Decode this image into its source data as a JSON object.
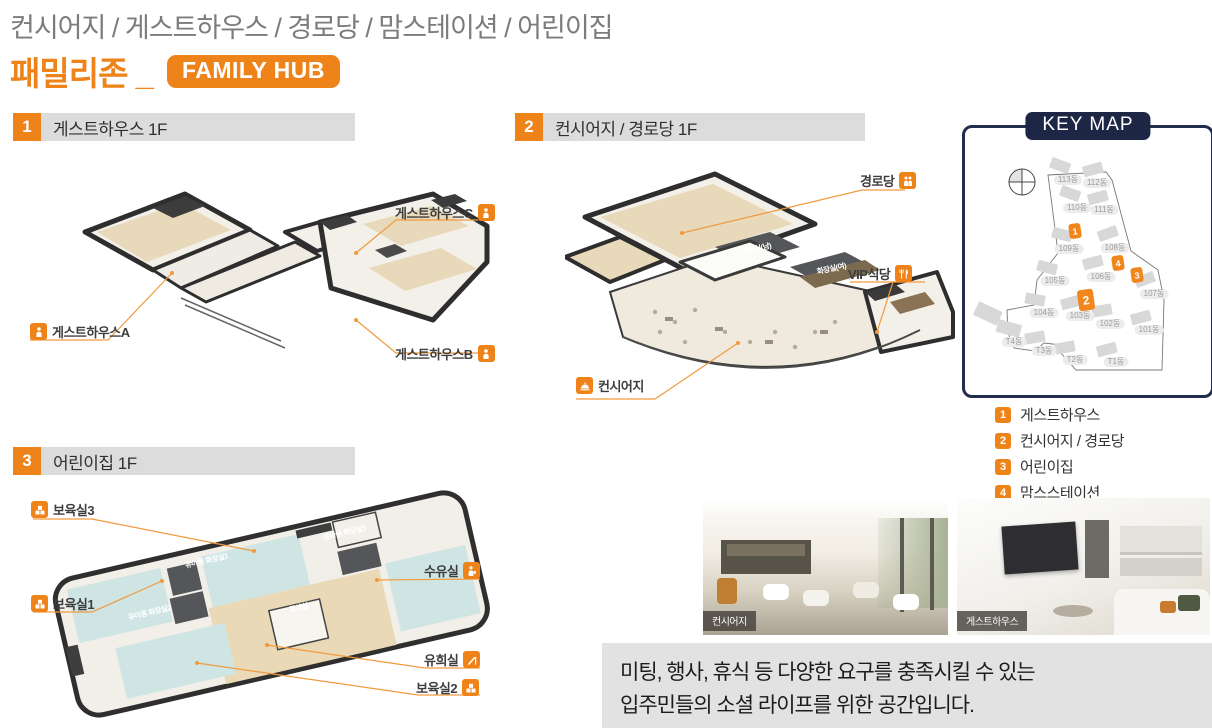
{
  "colors": {
    "accent": "#EE8319",
    "navy": "#1D2644",
    "section_bar": "#DCDCDC",
    "desc_bg": "#E2E2E2"
  },
  "header": {
    "subtitle": "컨시어지 / 게스트하우스 / 경로당 / 맘스테이션 / 어린이집",
    "title": "패밀리존 _",
    "badge": "FAMILY HUB"
  },
  "sections": [
    {
      "num": "1",
      "title": "게스트하우스 1F",
      "labels": [
        "게스트하우스C",
        "게스트하우스B",
        "게스트하우스A"
      ]
    },
    {
      "num": "2",
      "title": "컨시어지 / 경로당 1F",
      "labels": [
        "경로당",
        "VIP식당",
        "컨시어지"
      ],
      "rooms": [
        "화장실(남)",
        "화장실(여)"
      ]
    },
    {
      "num": "3",
      "title": "어린이집 1F",
      "labels": [
        "보육실3",
        "보육실1",
        "수유실",
        "유희실",
        "보육실2"
      ],
      "rooms": [
        "조리실",
        "유아용 화장실3",
        "유아용 화장실1",
        "유아용 화장실2",
        "교사실"
      ]
    }
  ],
  "keymap": {
    "title": "KEY MAP",
    "buildings": [
      "113동",
      "112동",
      "110동",
      "111동",
      "109동",
      "108동",
      "105동",
      "106동",
      "107동",
      "104동",
      "103동",
      "102동",
      "101동",
      "T4동",
      "T3동",
      "T2동",
      "T1동"
    ],
    "markers": [
      "1",
      "2",
      "3",
      "4"
    ]
  },
  "legend": [
    {
      "num": "1",
      "label": "게스트하우스"
    },
    {
      "num": "2",
      "label": "컨시어지 / 경로당"
    },
    {
      "num": "3",
      "label": "어린이집"
    },
    {
      "num": "4",
      "label": "맘스스테이션"
    }
  ],
  "photos": [
    {
      "caption": "컨시어지"
    },
    {
      "caption": "게스트하우스"
    }
  ],
  "description": {
    "line1": "미팅, 행사, 휴식 등 다양한 요구를 충족시킬 수 있는",
    "line2": "입주민들의 소셜 라이프를 위한 공간입니다."
  }
}
